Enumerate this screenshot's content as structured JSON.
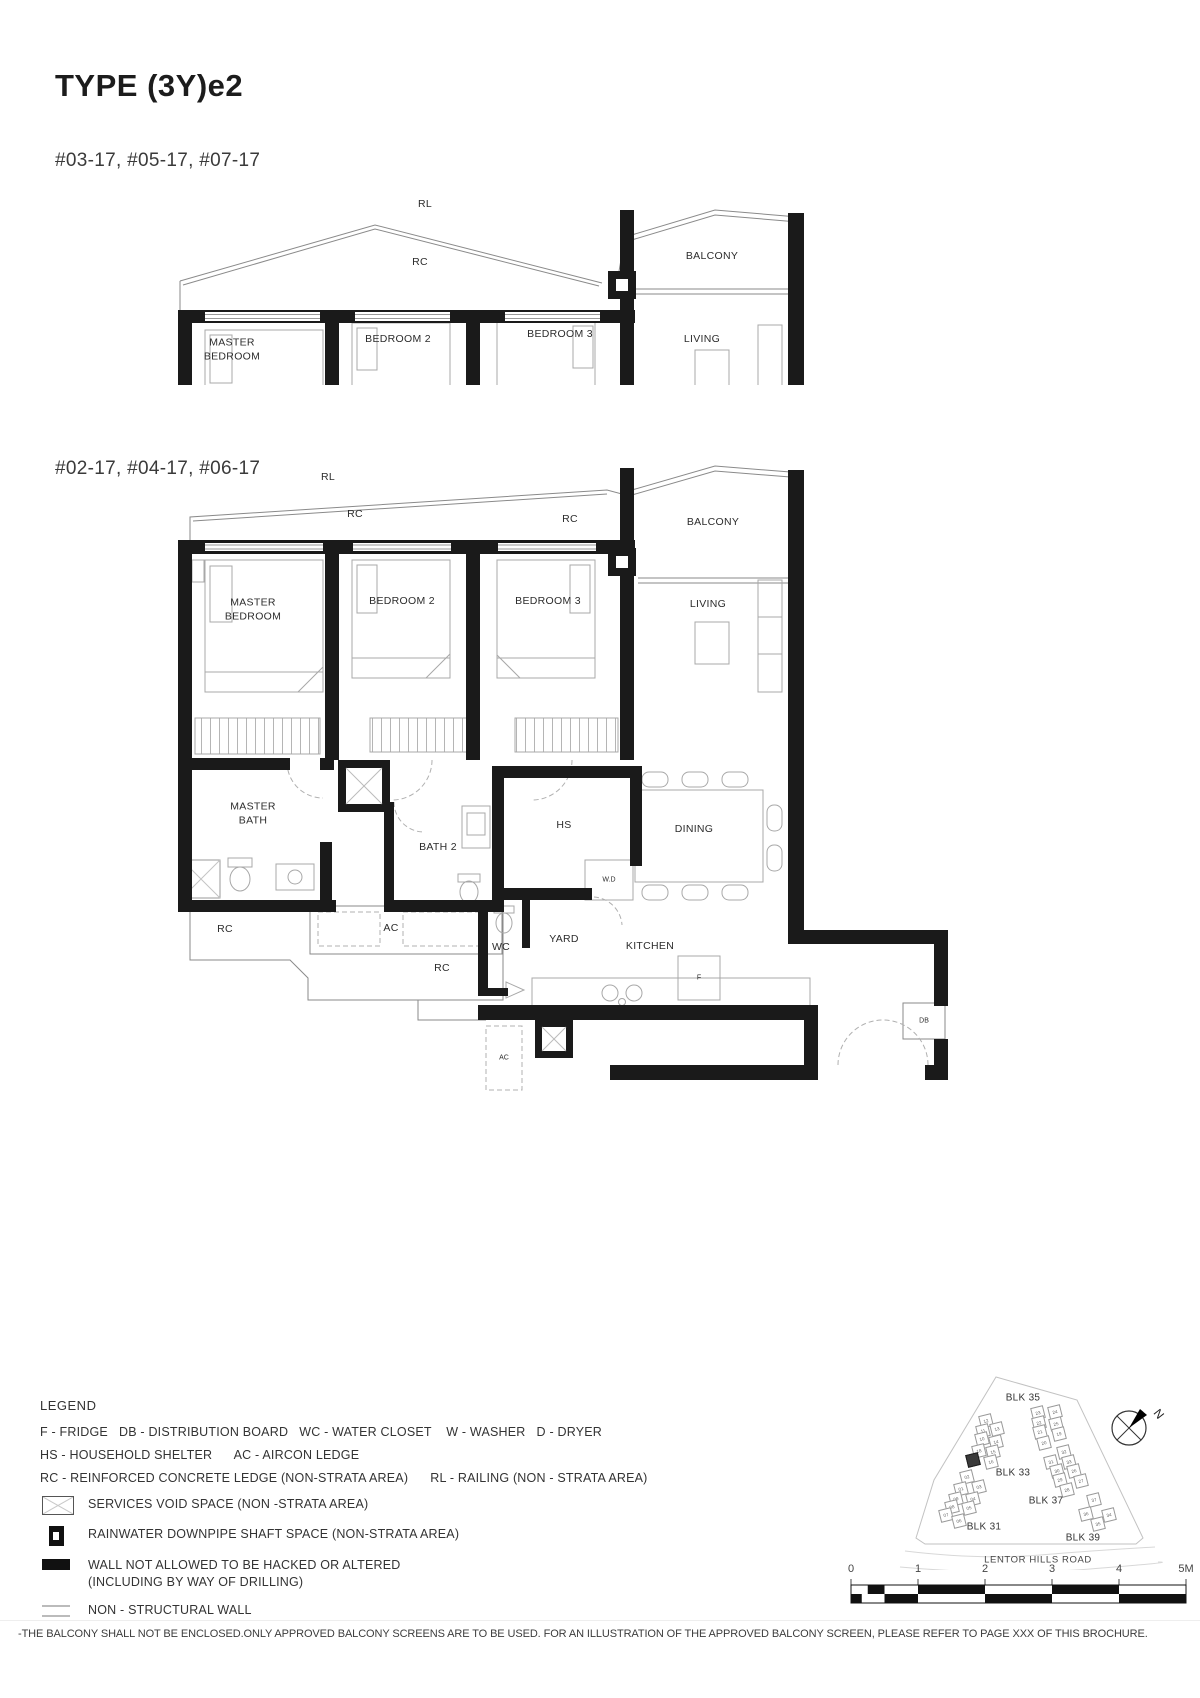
{
  "page": {
    "title": "TYPE (3Y)e2",
    "disclaimer": "-THE BALCONY SHALL NOT BE ENCLOSED.ONLY APPROVED BALCONY SCREENS ARE TO BE USED. FOR AN ILLUSTRATION OF THE APPROVED BALCONY SCREEN, PLEASE REFER TO PAGE XXX OF THIS BROCHURE."
  },
  "plans": {
    "plan1": {
      "units_label": "#03-17, #05-17, #07-17",
      "labels": [
        {
          "t": "RL",
          "x": 255,
          "y": 20
        },
        {
          "t": "RC",
          "x": 250,
          "y": 78
        },
        {
          "t": "BALCONY",
          "x": 542,
          "y": 72
        },
        {
          "t": "MASTER\nBEDROOM",
          "x": 62,
          "y": 165
        },
        {
          "t": "BEDROOM 2",
          "x": 228,
          "y": 155
        },
        {
          "t": "BEDROOM 3",
          "x": 390,
          "y": 150
        },
        {
          "t": "LIVING",
          "x": 532,
          "y": 155
        }
      ]
    },
    "plan2": {
      "units_label": "#02-17, #04-17, #06-17",
      "labels": [
        {
          "t": "RL",
          "x": 158,
          "y": 18
        },
        {
          "t": "RC",
          "x": 185,
          "y": 55
        },
        {
          "t": "RC",
          "x": 400,
          "y": 60
        },
        {
          "t": "BALCONY",
          "x": 543,
          "y": 63
        },
        {
          "t": "MASTER\nBEDROOM",
          "x": 83,
          "y": 150
        },
        {
          "t": "BEDROOM 2",
          "x": 232,
          "y": 142
        },
        {
          "t": "BEDROOM 3",
          "x": 378,
          "y": 142
        },
        {
          "t": "LIVING",
          "x": 538,
          "y": 145
        },
        {
          "t": "MASTER\nBATH",
          "x": 83,
          "y": 354
        },
        {
          "t": "BATH 2",
          "x": 268,
          "y": 388
        },
        {
          "t": "HS",
          "x": 394,
          "y": 366
        },
        {
          "t": "DINING",
          "x": 524,
          "y": 370
        },
        {
          "t": "RC",
          "x": 55,
          "y": 470
        },
        {
          "t": "AC",
          "x": 221,
          "y": 469
        },
        {
          "t": "W.D",
          "x": 439,
          "y": 420,
          "s": 1
        },
        {
          "t": "WC",
          "x": 331,
          "y": 488
        },
        {
          "t": "YARD",
          "x": 394,
          "y": 480
        },
        {
          "t": "KITCHEN",
          "x": 480,
          "y": 487
        },
        {
          "t": "F",
          "x": 529,
          "y": 518,
          "s": 1
        },
        {
          "t": "RC",
          "x": 272,
          "y": 509
        },
        {
          "t": "AC",
          "x": 334,
          "y": 598,
          "s": 1
        },
        {
          "t": "DB",
          "x": 754,
          "y": 561,
          "s": 1
        }
      ]
    }
  },
  "legend": {
    "title": "LEGEND",
    "abbreviations": [
      "F - FRIDGE   DB - DISTRIBUTION BOARD   WC - WATER CLOSET    W - WASHER   D - DRYER",
      "HS - HOUSEHOLD SHELTER      AC - AIRCON LEDGE",
      "RC - REINFORCED CONCRETE LEDGE (NON-STRATA AREA)      RL - RAILING (NON - STRATA AREA)"
    ],
    "symbols": [
      {
        "icon": "services-void-icon",
        "label": "SERVICES VOID SPACE (NON -STRATA AREA)"
      },
      {
        "icon": "rainwater-downpipe-icon",
        "label": "RAINWATER DOWNPIPE SHAFT SPACE (NON-STRATA AREA)"
      },
      {
        "icon": "hacking-wall-icon",
        "label": "WALL NOT ALLOWED TO BE HACKED OR ALTERED\n(INCLUDING BY WAY OF DRILLING)"
      },
      {
        "icon": "non-structural-wall-icon",
        "label": "NON - STRUCTURAL WALL"
      }
    ]
  },
  "site_plan": {
    "road_label": "LENTOR HILLS ROAD",
    "north_letter": "N",
    "blocks": [
      {
        "label": "BLK 35",
        "x": 173,
        "y": 128
      },
      {
        "label": "BLK 33",
        "x": 163,
        "y": 203
      },
      {
        "label": "BLK 37",
        "x": 196,
        "y": 231
      },
      {
        "label": "BLK 31",
        "x": 134,
        "y": 257
      },
      {
        "label": "BLK 39",
        "x": 233,
        "y": 268
      }
    ],
    "units": [
      {
        "n": "12",
        "x": 136,
        "y": 151
      },
      {
        "n": "13",
        "x": 147,
        "y": 159
      },
      {
        "n": "11",
        "x": 133,
        "y": 161
      },
      {
        "n": "10",
        "x": 132,
        "y": 169
      },
      {
        "n": "14",
        "x": 146,
        "y": 172
      },
      {
        "n": "15",
        "x": 143,
        "y": 182
      },
      {
        "n": "18",
        "x": 129,
        "y": 181
      },
      {
        "n": "16",
        "x": 141,
        "y": 192
      },
      {
        "n": "17",
        "x": 123,
        "y": 190,
        "dark": true
      },
      {
        "n": "02",
        "x": 117,
        "y": 207
      },
      {
        "n": "03",
        "x": 129,
        "y": 217
      },
      {
        "n": "01",
        "x": 111,
        "y": 219
      },
      {
        "n": "09",
        "x": 106,
        "y": 229
      },
      {
        "n": "04",
        "x": 123,
        "y": 229
      },
      {
        "n": "08",
        "x": 102,
        "y": 237
      },
      {
        "n": "05",
        "x": 119,
        "y": 238
      },
      {
        "n": "07",
        "x": 96,
        "y": 245
      },
      {
        "n": "06",
        "x": 109,
        "y": 251
      },
      {
        "n": "23",
        "x": 188,
        "y": 143
      },
      {
        "n": "24",
        "x": 205,
        "y": 142
      },
      {
        "n": "22",
        "x": 189,
        "y": 153
      },
      {
        "n": "25",
        "x": 206,
        "y": 154
      },
      {
        "n": "21",
        "x": 190,
        "y": 162
      },
      {
        "n": "19",
        "x": 209,
        "y": 164
      },
      {
        "n": "20",
        "x": 194,
        "y": 173
      },
      {
        "n": "32",
        "x": 214,
        "y": 182
      },
      {
        "n": "31",
        "x": 201,
        "y": 192
      },
      {
        "n": "33",
        "x": 219,
        "y": 192
      },
      {
        "n": "30",
        "x": 207,
        "y": 201
      },
      {
        "n": "26",
        "x": 224,
        "y": 201
      },
      {
        "n": "29",
        "x": 210,
        "y": 210
      },
      {
        "n": "27",
        "x": 231,
        "y": 211
      },
      {
        "n": "28",
        "x": 217,
        "y": 220
      },
      {
        "n": "37",
        "x": 244,
        "y": 230
      },
      {
        "n": "36",
        "x": 236,
        "y": 244
      },
      {
        "n": "34",
        "x": 259,
        "y": 245
      },
      {
        "n": "35",
        "x": 248,
        "y": 254
      }
    ]
  },
  "scale_bar": {
    "ticks": [
      "0",
      "1",
      "2",
      "3",
      "4",
      "5M"
    ]
  }
}
